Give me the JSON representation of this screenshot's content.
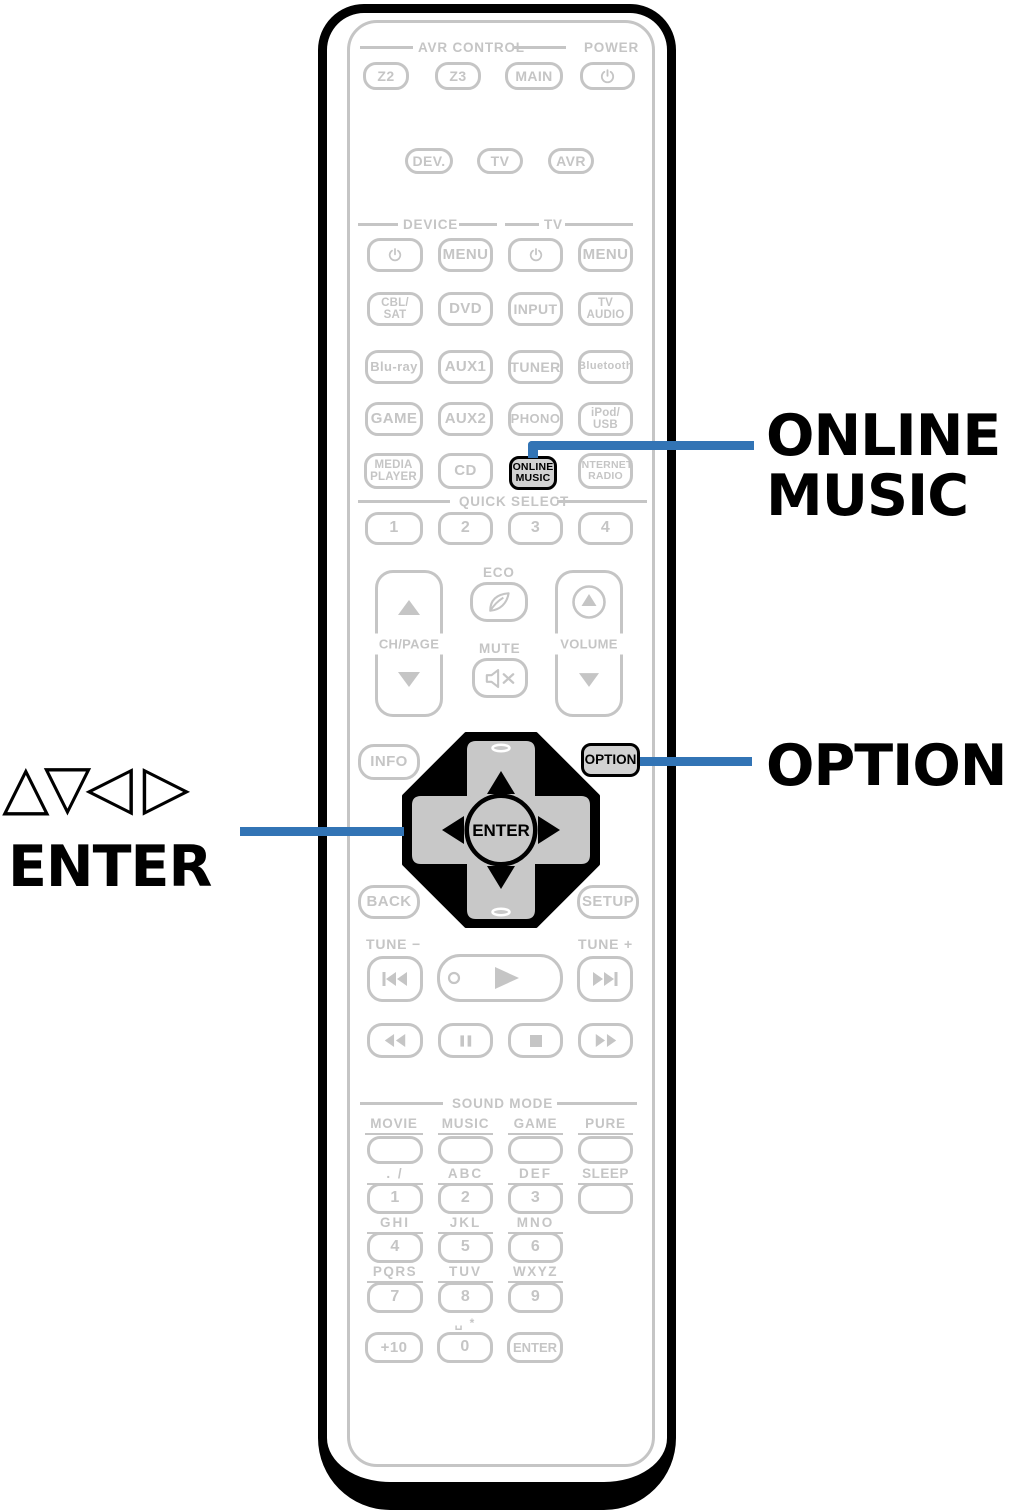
{
  "callouts": {
    "line_color": "#3274b5",
    "online_music": {
      "line1": "ONLINE",
      "line2": "MUSIC"
    },
    "option": {
      "label": "OPTION"
    },
    "cursor": {
      "symbols": "△▽◁ ▷",
      "label": "ENTER"
    }
  },
  "remote": {
    "avr_control": {
      "label": "AVR CONTROL",
      "power_label": "POWER",
      "z2": "Z2",
      "z3": "Z3",
      "main": "MAIN"
    },
    "mode_row": {
      "dev": "DEV.",
      "tv": "TV",
      "avr": "AVR"
    },
    "device_section_label": "DEVICE",
    "tv_section_label": "TV",
    "sources": {
      "device_menu": "MENU",
      "tv_menu": "MENU",
      "cbl1": "CBL/",
      "cbl2": "SAT",
      "dvd": "DVD",
      "input": "INPUT",
      "tvaudio1": "TV",
      "tvaudio2": "AUDIO",
      "bluray": "Blu-ray",
      "aux1": "AUX1",
      "tuner": "TUNER",
      "bluetooth": "Bluetooth",
      "game": "GAME",
      "aux2": "AUX2",
      "phono": "PHONO",
      "ipod1": "iPod/",
      "ipod2": "USB",
      "media1": "MEDIA",
      "media2": "PLAYER",
      "cd": "CD",
      "online1": "ONLINE",
      "online2": "MUSIC",
      "inet1": "INTERNET",
      "inet2": "RADIO"
    },
    "quick_select": {
      "label": "QUICK SELECT",
      "b1": "1",
      "b2": "2",
      "b3": "3",
      "b4": "4"
    },
    "center": {
      "eco": "ECO",
      "ch_page": "CH/PAGE",
      "mute": "MUTE",
      "volume": "VOLUME"
    },
    "nav": {
      "info": "INFO",
      "option": "OPTION",
      "back": "BACK",
      "setup": "SETUP",
      "enter": "ENTER"
    },
    "tune": {
      "minus": "TUNE −",
      "plus": "TUNE +"
    },
    "sound_mode": {
      "label": "SOUND MODE",
      "movie": "MOVIE",
      "music": "MUSIC",
      "game": "GAME",
      "pure": "PURE"
    },
    "keypad": {
      "l1": ". /",
      "l2": "ABC",
      "l3": "DEF",
      "lsleep": "SLEEP",
      "l4": "GHI",
      "l5": "JKL",
      "l6": "MNO",
      "l7": "PQRS",
      "l8": "TUV",
      "l9": "WXYZ",
      "l0": "␣ *",
      "n1": "1",
      "n2": "2",
      "n3": "3",
      "n4": "4",
      "n5": "5",
      "n6": "6",
      "n7": "7",
      "n8": "8",
      "n9": "9",
      "plus10": "+10",
      "n0": "0",
      "enter": "ENTER"
    },
    "icons": {
      "power": "power-icon",
      "eco": "leaf-icon",
      "mute": "speaker-mute-icon",
      "volume_up": "volume-up-icon",
      "volume_down": "volume-down-icon",
      "channel_up": "channel-up-icon",
      "channel_down": "channel-down-icon",
      "skip_back": "skip-back-icon",
      "play": "play-icon",
      "skip_forward": "skip-forward-icon",
      "rewind": "rewind-icon",
      "pause": "pause-icon",
      "stop": "stop-icon",
      "fast_forward": "fast-forward-icon",
      "cursor_up": "up-arrow-icon",
      "cursor_down": "down-arrow-icon",
      "cursor_left": "left-arrow-icon",
      "cursor_right": "right-arrow-icon"
    }
  }
}
